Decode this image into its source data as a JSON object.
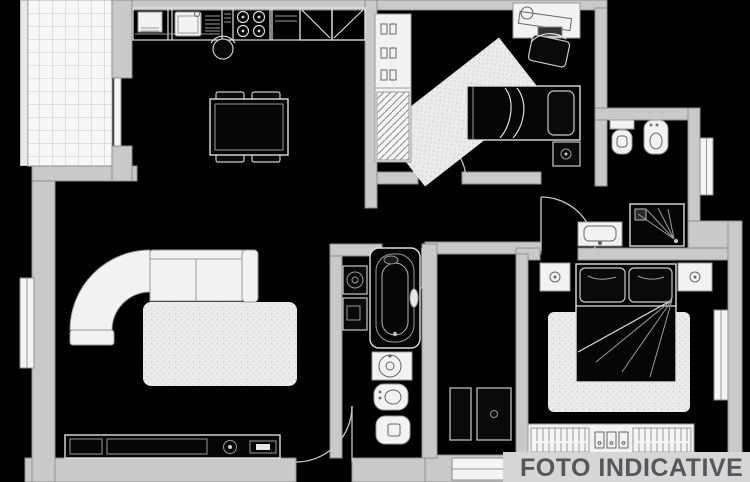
{
  "watermark": {
    "label": "FOTO INDICATIVE"
  },
  "colors": {
    "background": "#000000",
    "wall-fill": "#c9c9c9",
    "wall-stroke": "#8e8e8e",
    "line-light": "#dedede",
    "line-mid": "#9a9a9a",
    "fixture-fill": "#f2f2f2",
    "watermark-text": "#54585c",
    "watermark-band": "#d6d6d6"
  },
  "legend": {
    "icons": [
      "balcony-tiles",
      "kitchen-sink-icon",
      "stove-icon",
      "corner-cabinet-icon",
      "dining-table",
      "stool-icon",
      "sofa",
      "rug",
      "tv-cabinet",
      "entry-door-swing",
      "window",
      "wardrobe",
      "desk",
      "desk-chair-icon",
      "single-bed",
      "nightstand",
      "bathtub-icon",
      "washbasin-icon",
      "bidet-icon",
      "toilet-icon",
      "washing-machine-icon",
      "shower-icon",
      "double-bed",
      "hall-cabinet"
    ]
  }
}
